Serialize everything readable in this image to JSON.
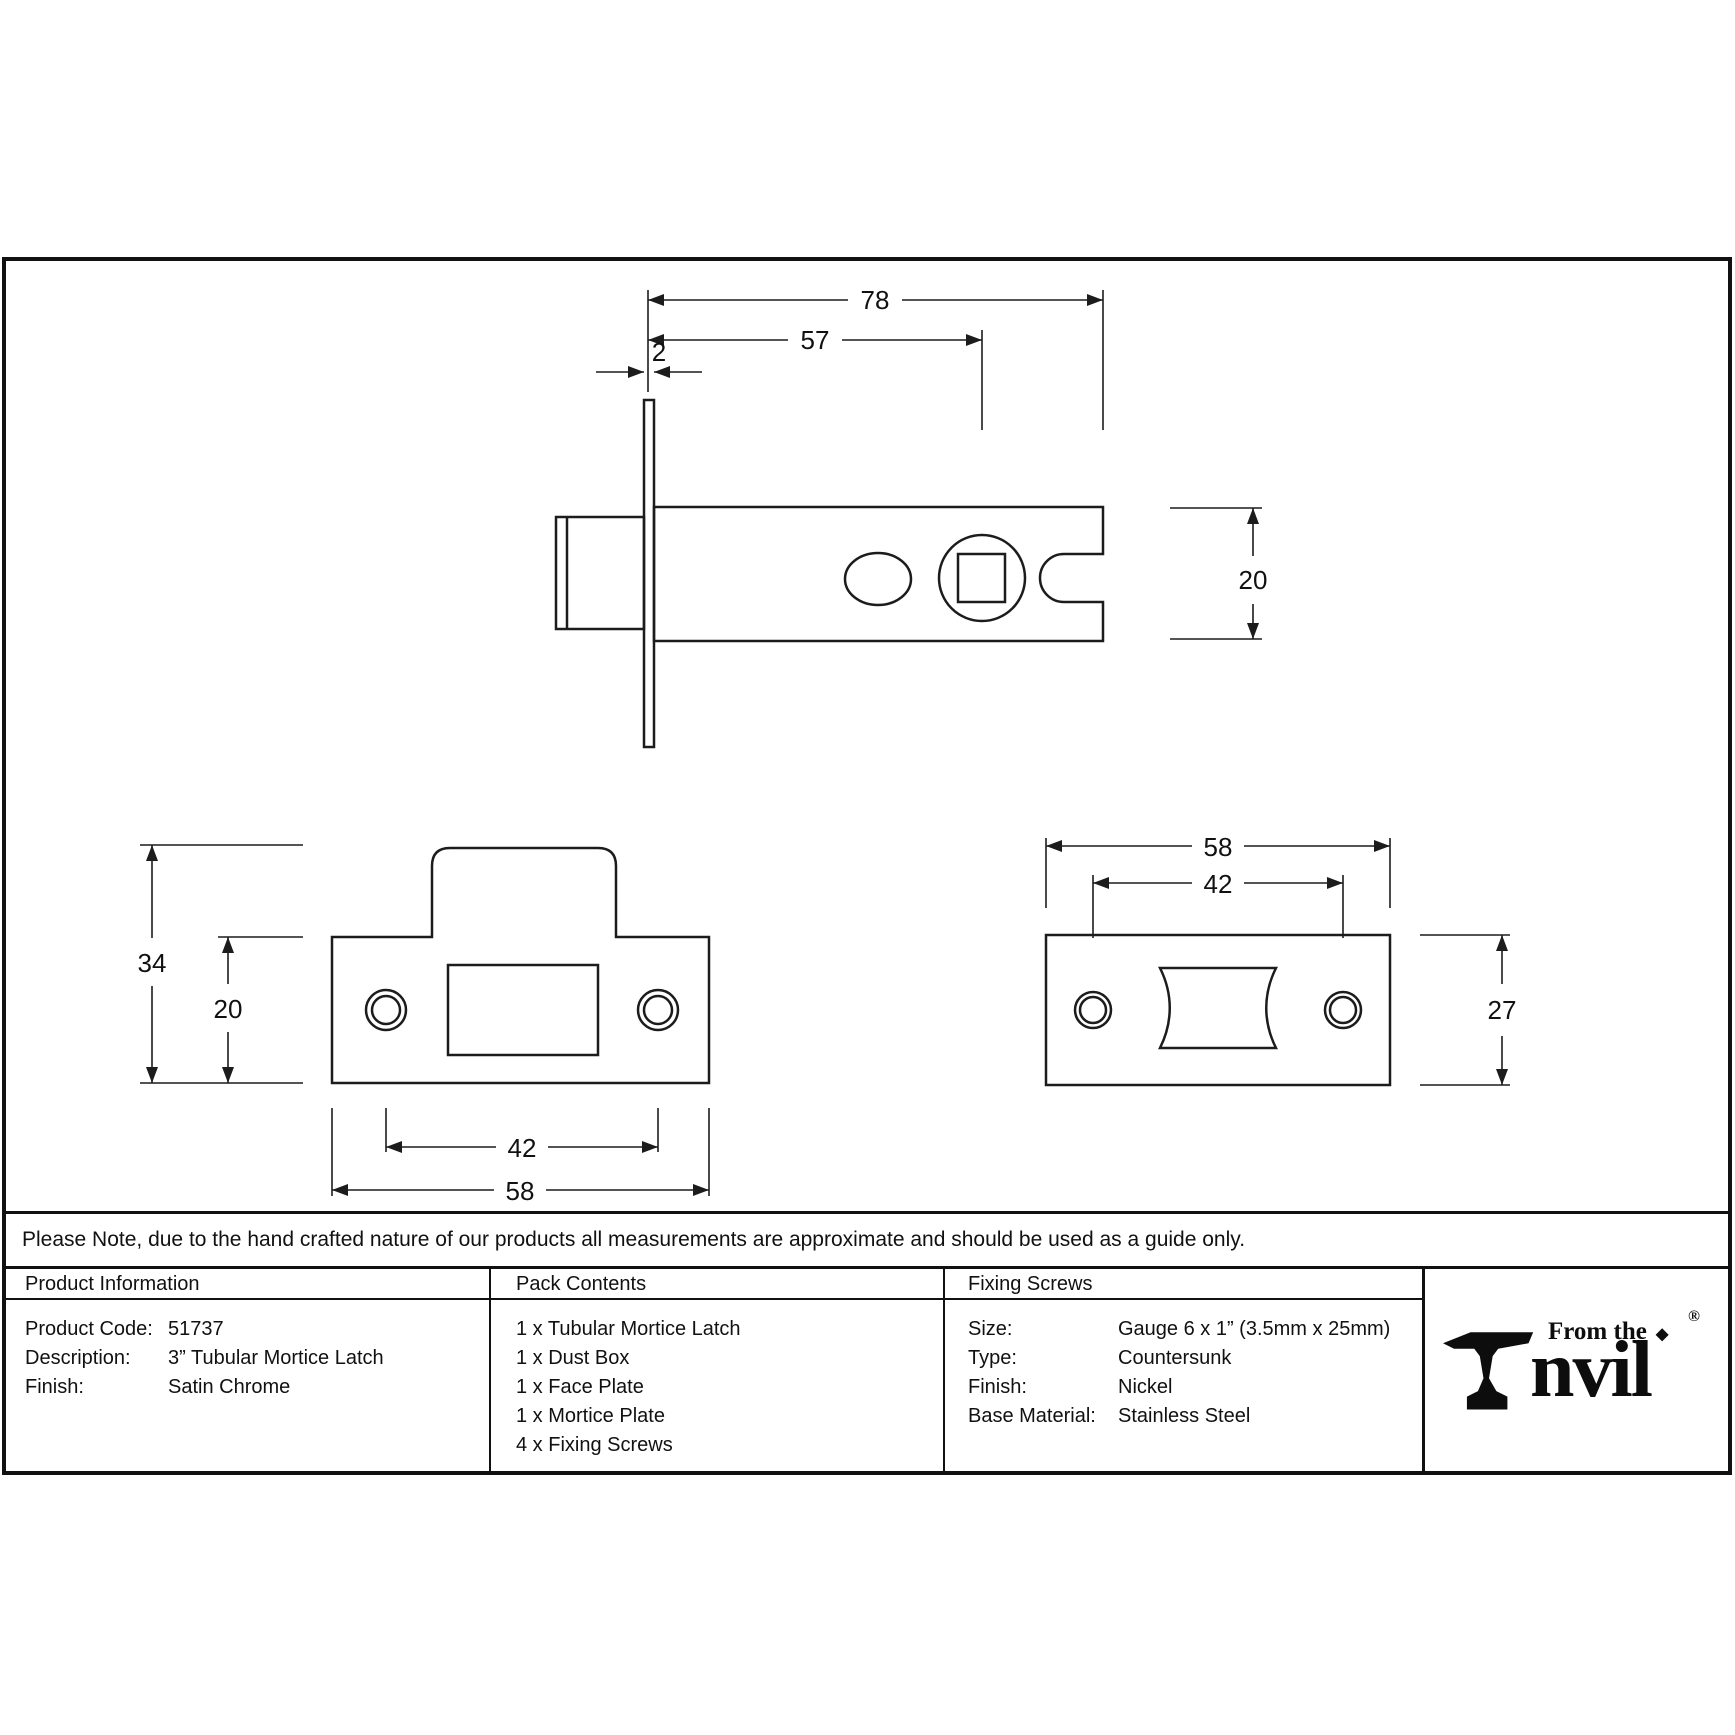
{
  "note": "Please Note, due to the hand crafted nature of our products all measurements are approximate and should be used as a guide only.",
  "dims": {
    "latch": {
      "overall": "78",
      "backset": "57",
      "faceplate_thickness": "2",
      "height": "20"
    },
    "face_plate": {
      "overall_height": "34",
      "plate_height": "20",
      "screw_centres": "42",
      "width": "58"
    },
    "mortice_plate": {
      "width": "58",
      "screw_centres": "42",
      "height": "27"
    }
  },
  "table": {
    "product_information": {
      "header": "Product Information",
      "rows": [
        {
          "label": "Product Code:",
          "value": "51737"
        },
        {
          "label": "Description:",
          "value": "3” Tubular Mortice Latch"
        },
        {
          "label": "Finish:",
          "value": "Satin Chrome"
        }
      ]
    },
    "pack_contents": {
      "header": "Pack Contents",
      "items": [
        "1 x Tubular Mortice Latch",
        "1 x Dust Box",
        "1 x Face Plate",
        "1 x Mortice Plate",
        "4 x Fixing Screws"
      ]
    },
    "fixing_screws": {
      "header": "Fixing Screws",
      "rows": [
        {
          "label": "Size:",
          "value": "Gauge 6 x 1” (3.5mm x 25mm)"
        },
        {
          "label": "Type:",
          "value": "Countersunk"
        },
        {
          "label": "Finish:",
          "value": "Nickel"
        },
        {
          "label": "Base Material:",
          "value": "Stainless Steel"
        }
      ]
    }
  },
  "logo": {
    "prefix": "From the",
    "brand_suffix": "nvil",
    "diamond": "◆",
    "registered": "®"
  },
  "colors": {
    "line": "#1c1c1c"
  }
}
